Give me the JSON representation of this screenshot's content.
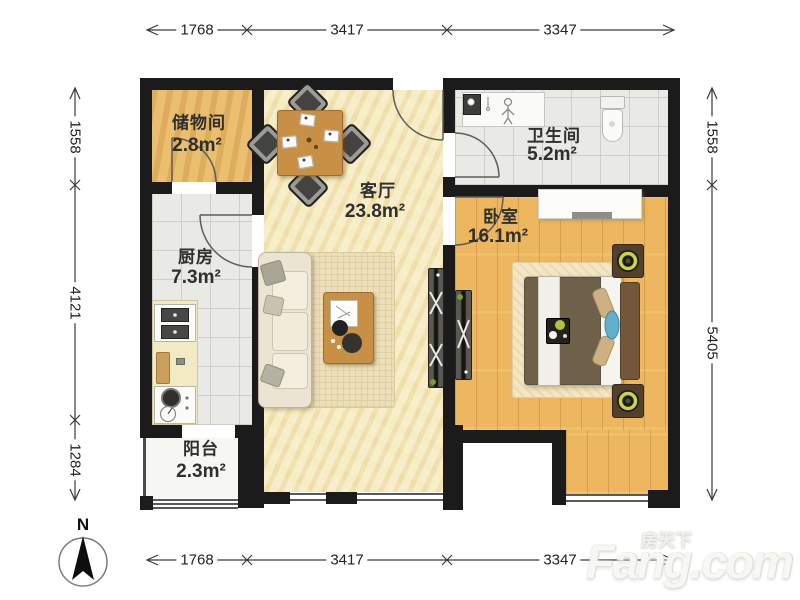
{
  "rooms": [
    {
      "id": "storage",
      "name": "储物间",
      "area": "2.8m²"
    },
    {
      "id": "living",
      "name": "客厅",
      "area": "23.8m²"
    },
    {
      "id": "bathroom",
      "name": "卫生间",
      "area": "5.2m²"
    },
    {
      "id": "bedroom",
      "name": "卧室",
      "area": "16.1m²"
    },
    {
      "id": "kitchen",
      "name": "厨房",
      "area": "7.3m²"
    },
    {
      "id": "balcony",
      "name": "阳台",
      "area": "2.3m²"
    }
  ],
  "dimensions": {
    "top": [
      "1768",
      "3417",
      "3347"
    ],
    "bottom": [
      "1768",
      "3417",
      "3347"
    ],
    "left": [
      "1558",
      "4121",
      "1284"
    ],
    "right": [
      "1558",
      "5405"
    ]
  },
  "compass": {
    "label": "N"
  },
  "watermark": {
    "cjk": "房天下",
    "latin": "Fang.com"
  },
  "colors": {
    "wall": "#1b1b1b",
    "living_floor": "#f5ecc6",
    "bedroom_floor": "#edb75f",
    "storage_floor": "#e7b969",
    "tile_floor": "#e9e9e5",
    "wood_furniture": "#c79045",
    "lamp_ring": "#c9d44c",
    "accent_blue": "#5fb0cc"
  },
  "icons": [
    "north-arrow-icon",
    "sofa",
    "dining-table",
    "coffee-table",
    "tv-console",
    "bed",
    "nightstand-lamp",
    "wardrobe",
    "toilet",
    "bathroom-sink",
    "kitchen-sink",
    "stove",
    "shower-person-icon"
  ]
}
